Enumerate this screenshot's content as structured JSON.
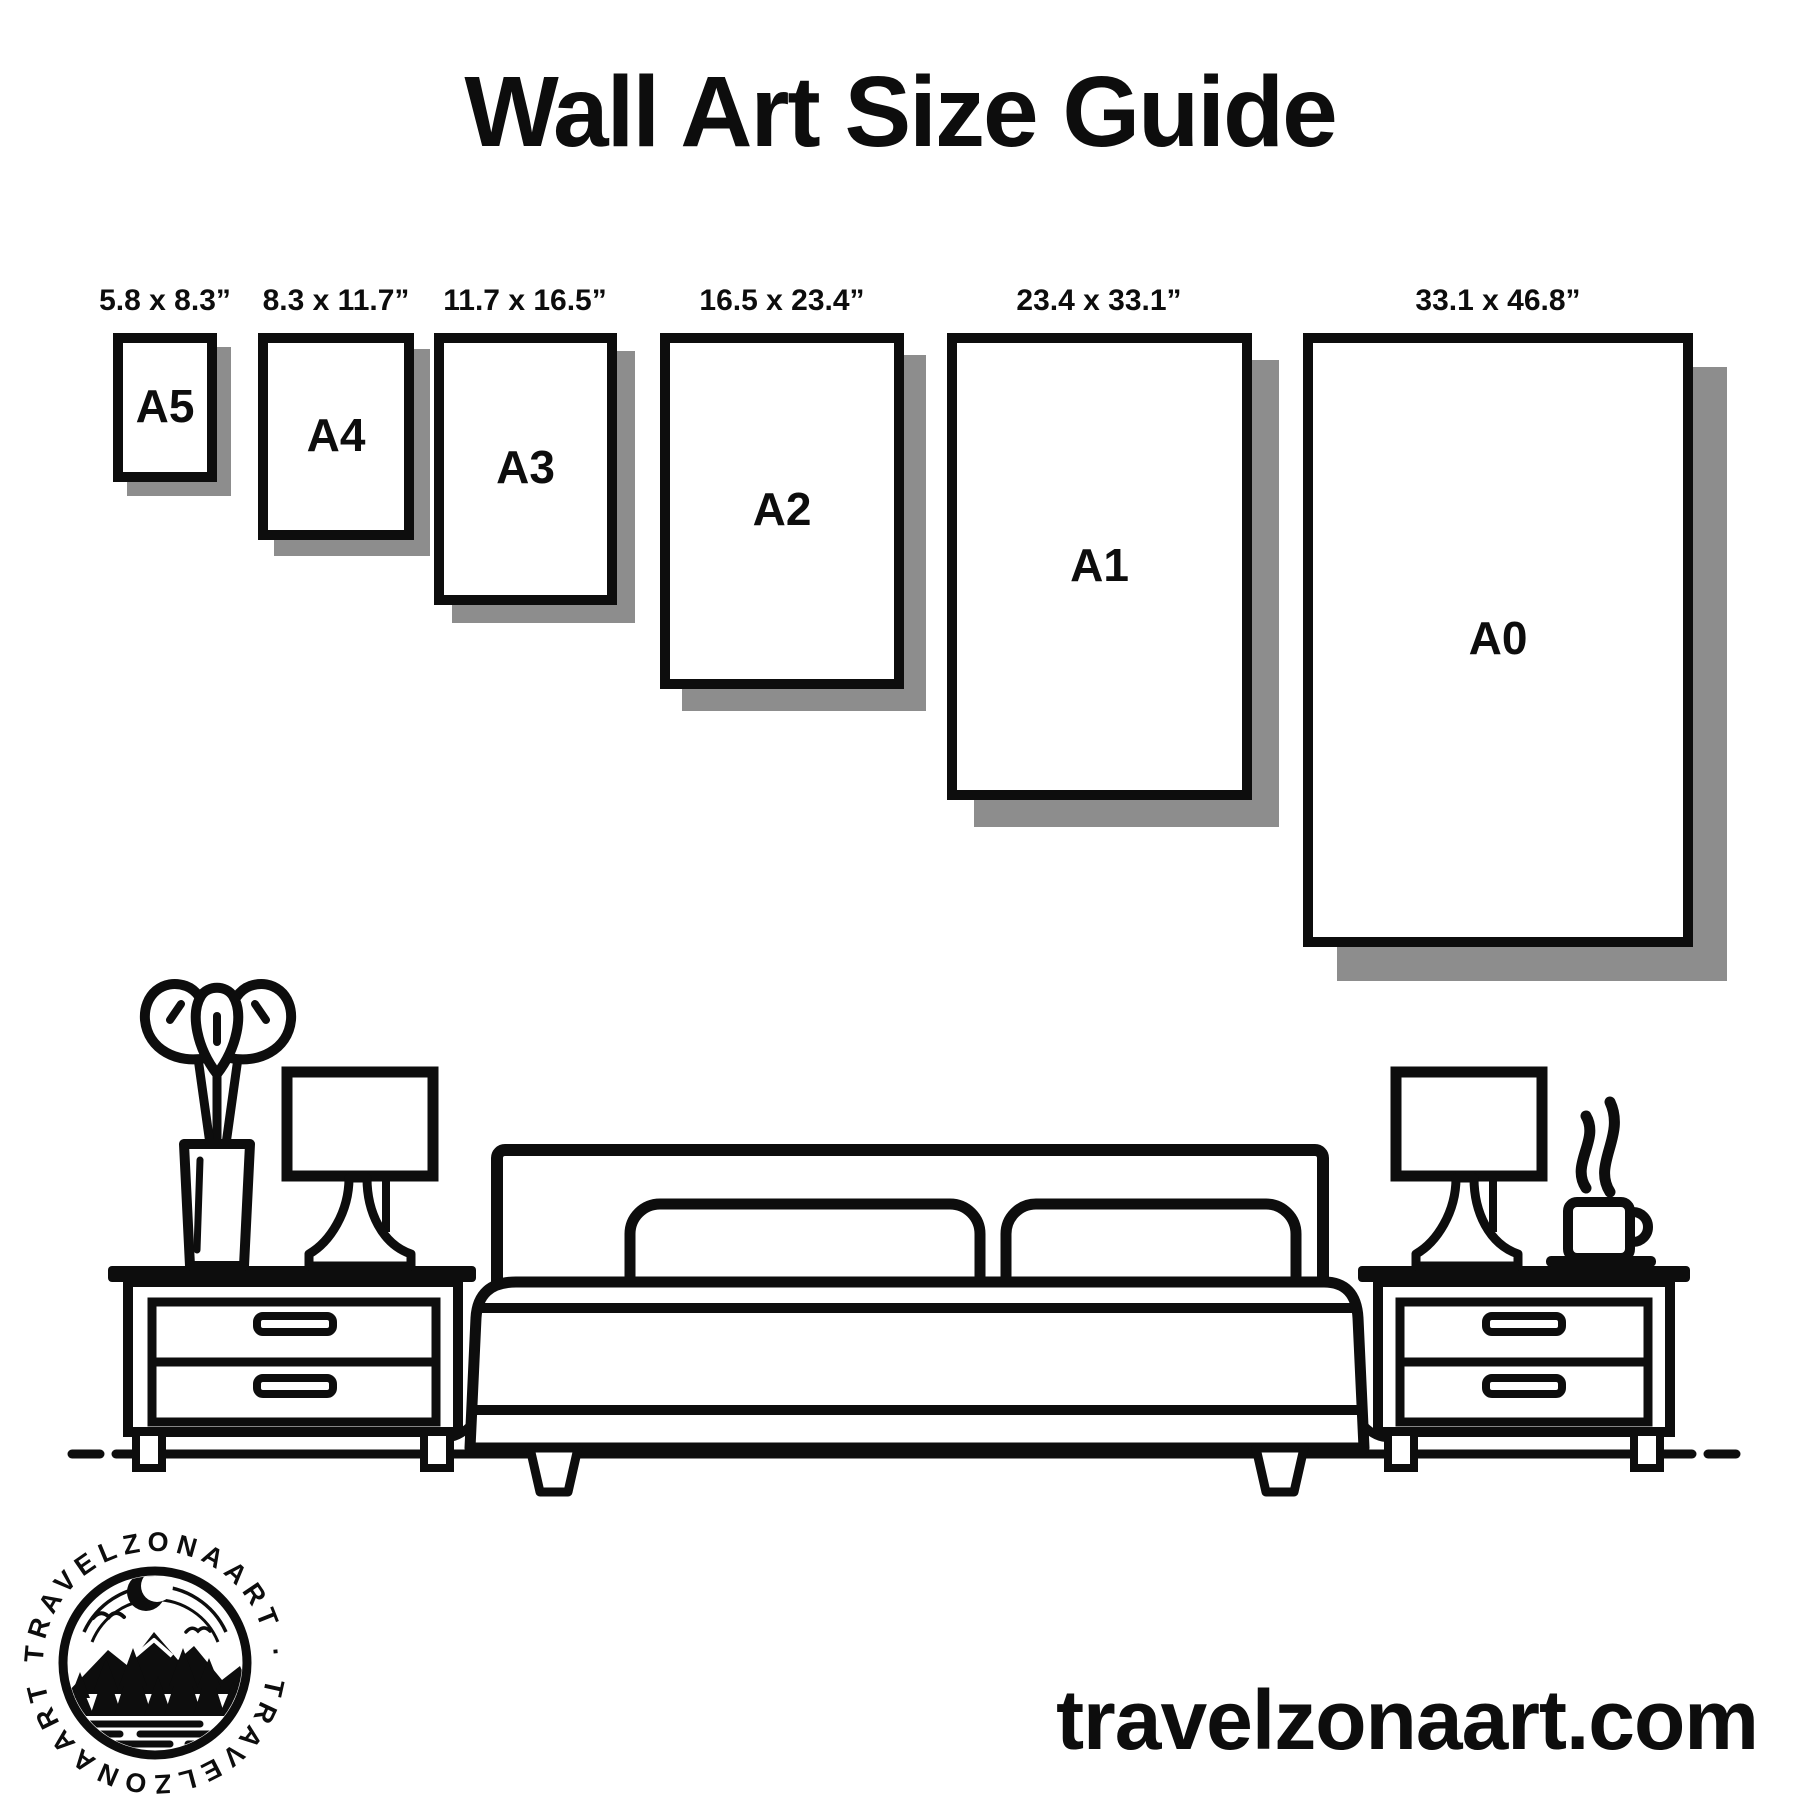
{
  "title": "Wall Art Size Guide",
  "sizes": [
    {
      "code": "A5",
      "dimensions": "5.8 x 8.3”"
    },
    {
      "code": "A4",
      "dimensions": "8.3 x 11.7”"
    },
    {
      "code": "A3",
      "dimensions": "11.7 x 16.5”"
    },
    {
      "code": "A2",
      "dimensions": "16.5 x 23.4”"
    },
    {
      "code": "A1",
      "dimensions": "23.4 x 33.1”"
    },
    {
      "code": "A0",
      "dimensions": "33.1 x 46.8”"
    }
  ],
  "logo": {
    "brand": "TRAVELZONAART",
    "ring_text": "TRAVELZONAART · TRAVELZONAART ·"
  },
  "website": "travelzonaart.com",
  "colors": {
    "ink": "#0d0d0d",
    "shadow": "#8d8d8d",
    "background": "#ffffff"
  }
}
